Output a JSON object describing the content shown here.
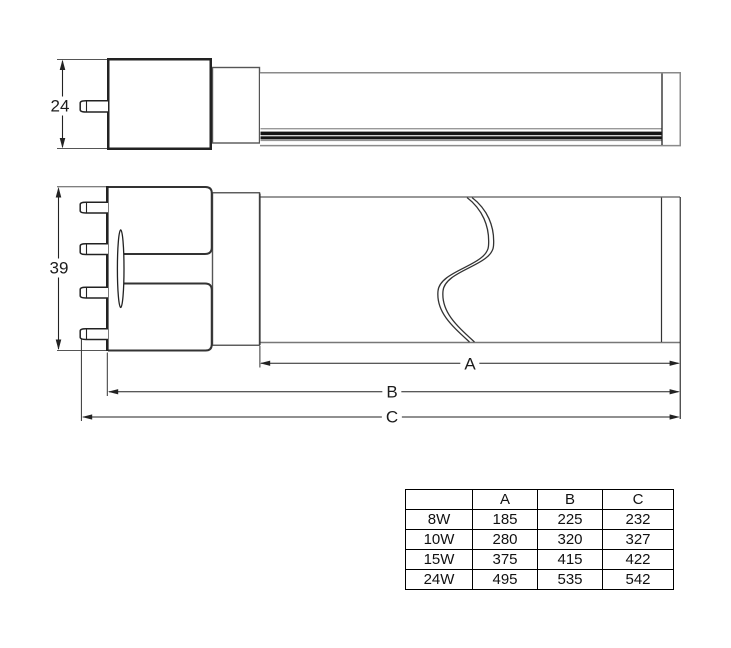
{
  "drawing": {
    "side_view": {
      "height_dim": "24"
    },
    "front_view": {
      "height_dim": "39"
    },
    "length_dims": {
      "a": "A",
      "b": "B",
      "c": "C"
    }
  },
  "table": {
    "col_headers": [
      "",
      "A",
      "B",
      "C"
    ],
    "rows": [
      [
        "8W",
        "185",
        "225",
        "232"
      ],
      [
        "10W",
        "280",
        "320",
        "327"
      ],
      [
        "15W",
        "375",
        "415",
        "422"
      ],
      [
        "24W",
        "495",
        "535",
        "542"
      ]
    ]
  },
  "colors": {
    "line_dark": "#222222",
    "line_gray": "#8a8a8a",
    "led_strip": "#141414",
    "background": "#ffffff"
  }
}
